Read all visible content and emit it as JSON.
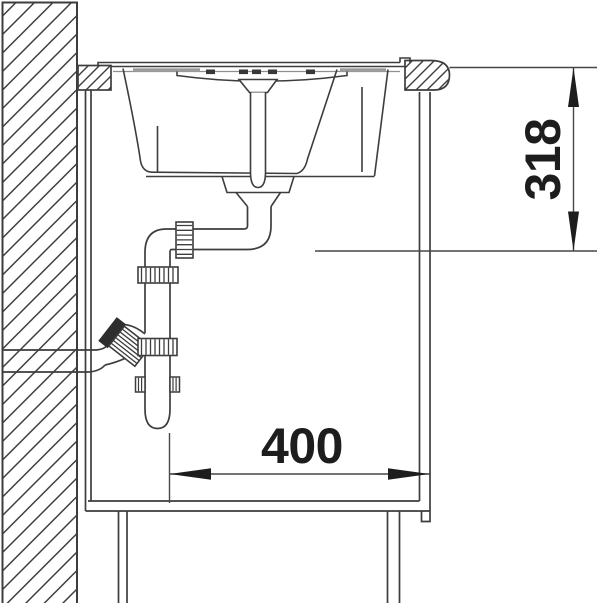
{
  "drawing": {
    "type": "technical-installation-drawing",
    "description": "Side cross-section of a sink mounted in a base cabinet against a wall, showing bowl, standpipe drain, trap piping with union nuts and wall outlet",
    "dimensions": {
      "height": {
        "label": "318",
        "value": 318,
        "orientation": "vertical",
        "arrow_style": "filled-slender"
      },
      "width": {
        "label": "400",
        "value": 400,
        "orientation": "horizontal",
        "arrow_style": "filled-slender"
      }
    },
    "parts": [
      "wall-hatched",
      "countertop-left-section",
      "countertop-right-section-rounded-nose",
      "sink-rim",
      "sink-bowl",
      "overflow-standpipe",
      "drain-outlet",
      "trap-elbow-pipe",
      "knurled-union-nuts",
      "wall-outlet-pipe",
      "cabinet-side-panels",
      "cabinet-floor",
      "plinth"
    ],
    "colors": {
      "background": "#ffffff",
      "line": "#3d3d3d",
      "dimension_line": "#474747",
      "dimension_text": "#1d1d1d",
      "seal_gray": "#9b9b9b",
      "fitting_dark": "#2e2e2e"
    }
  }
}
